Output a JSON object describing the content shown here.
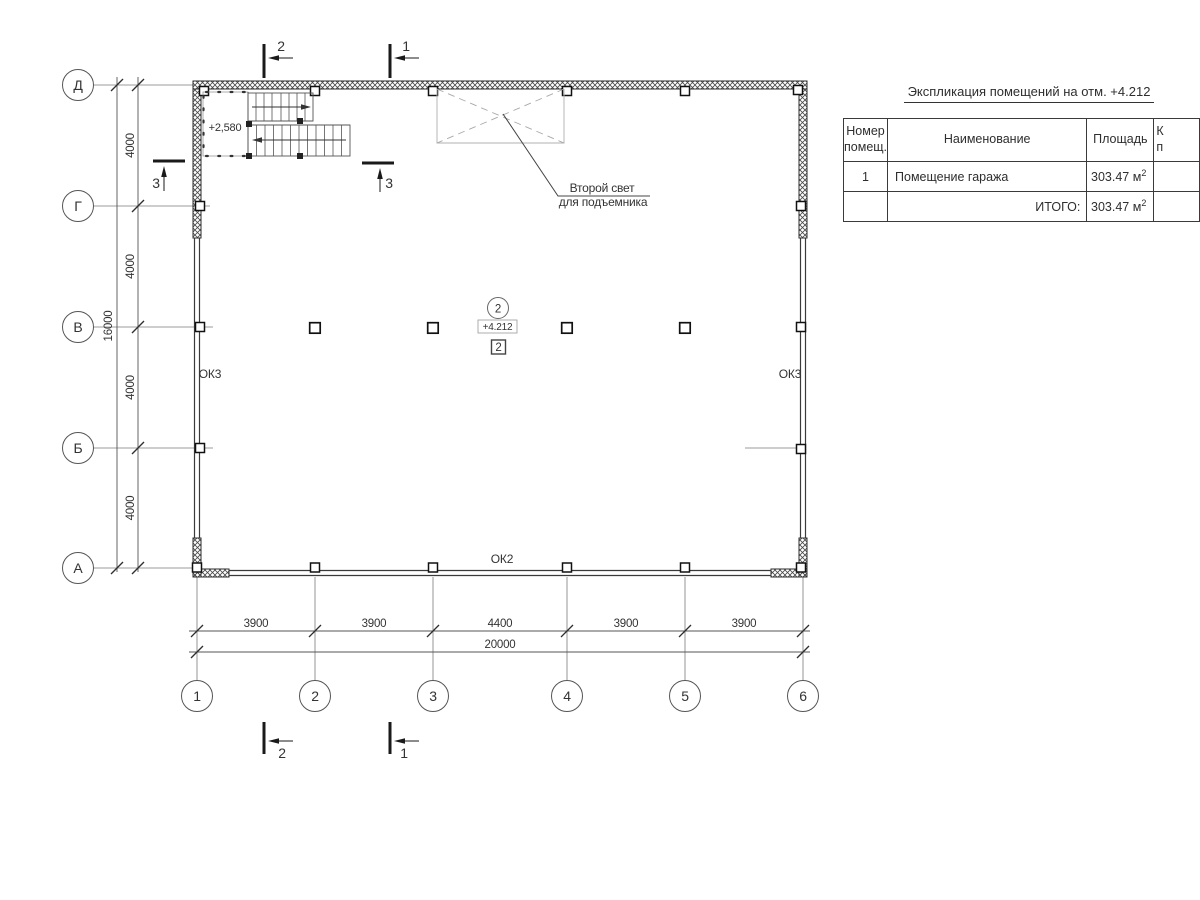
{
  "title": {
    "text": "Экспликация помещений на отм. +4.212"
  },
  "table": {
    "col_num_line1": "Номер",
    "col_num_line2": "помещ.",
    "col_name": "Наименование",
    "col_area": "Площадь",
    "col_cat_line1": "К",
    "col_cat_line2": "п",
    "rows": [
      {
        "num": "1",
        "name": "Помещение гаража",
        "area": "303.47 м",
        "area_sup": "2"
      }
    ],
    "total_label": "ИТОГО:",
    "total_area": "303.47 м",
    "total_area_sup": "2"
  },
  "axes": {
    "rows": [
      "Д",
      "Г",
      "В",
      "Б",
      "А"
    ],
    "cols": [
      "1",
      "2",
      "3",
      "4",
      "5",
      "6"
    ]
  },
  "dims": {
    "v_segments": [
      "4000",
      "4000",
      "4000",
      "4000"
    ],
    "v_total": "16000",
    "h_segments": [
      "3900",
      "3900",
      "4400",
      "3900",
      "3900"
    ],
    "h_total": "20000"
  },
  "sections": {
    "top_left": "2",
    "top_right": "1",
    "bottom_left": "2",
    "bottom_right": "1",
    "side_left": "3",
    "side_stairs": "3"
  },
  "plan": {
    "stairs_level": "+2,580",
    "window_left": "ОК3",
    "window_right": "ОК3",
    "window_bottom": "ОК2",
    "room_number_circle": "2",
    "room_level": "+4.212",
    "room_number_box": "2",
    "annotation_line1": "Второй свет",
    "annotation_line2": "для подъемника"
  },
  "colors": {
    "background": "#ffffff",
    "line_dark": "#2b2b2b",
    "line_mid": "#555555",
    "line_light": "#a8a8a8",
    "text": "#333333"
  }
}
